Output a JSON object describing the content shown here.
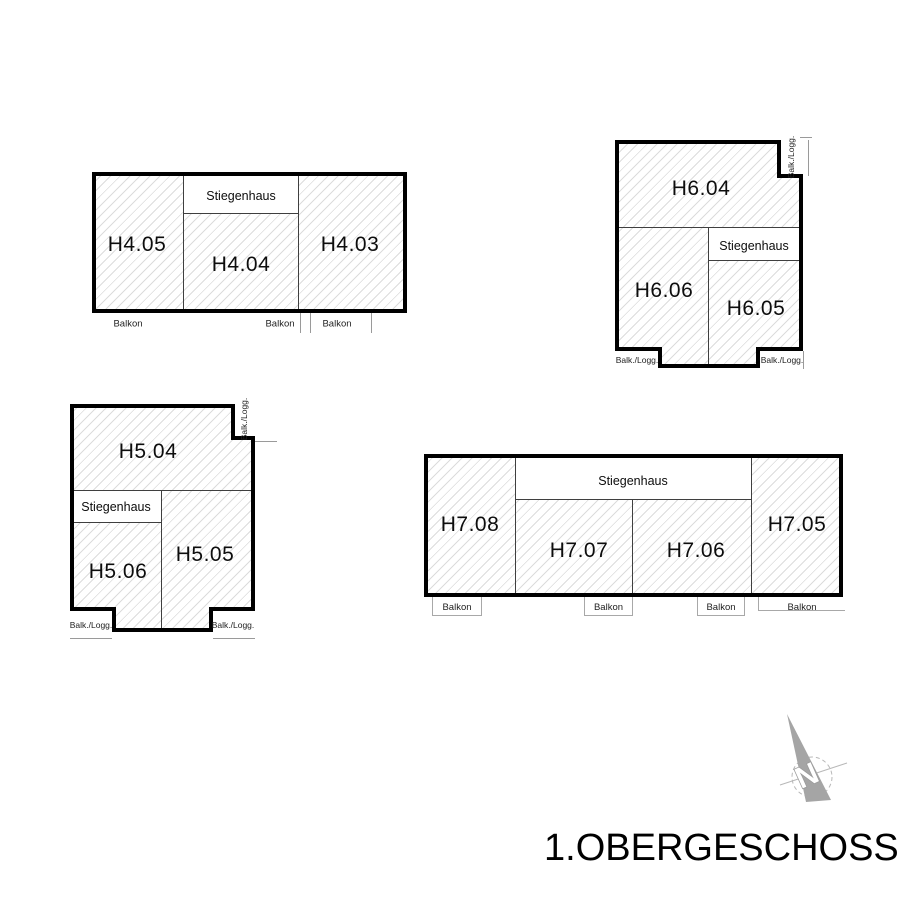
{
  "title": "1.OBERGESCHOSS",
  "north": {
    "letter": "N"
  },
  "colors": {
    "wall": "#000000",
    "partition": "#3f3f3f",
    "hatch_line": "#dcdcdc",
    "annotation_line": "#9a9a9a",
    "arrow_gray": "#a5a5a5"
  },
  "h4": {
    "units": [
      "H4.05",
      "H4.04",
      "H4.03"
    ],
    "stairwell": "Stiegenhaus",
    "balconies": [
      "Balkon",
      "Balkon",
      "Balkon"
    ]
  },
  "h6": {
    "units": [
      "H6.04",
      "H6.06",
      "H6.05"
    ],
    "stairwell": "Stiegenhaus",
    "loggias": [
      "Balk./Logg.",
      "Balk./Logg.",
      "Balk./Logg."
    ]
  },
  "h5": {
    "units": [
      "H5.04",
      "H5.06",
      "H5.05"
    ],
    "stairwell": "Stiegenhaus",
    "loggias": [
      "Balk./Logg.",
      "Balk./Logg.",
      "Balk./Logg."
    ]
  },
  "h7": {
    "units": [
      "H7.08",
      "H7.07",
      "H7.06",
      "H7.05"
    ],
    "stairwell": "Stiegenhaus",
    "balconies": [
      "Balkon",
      "Balkon",
      "Balkon",
      "Balkon"
    ]
  }
}
